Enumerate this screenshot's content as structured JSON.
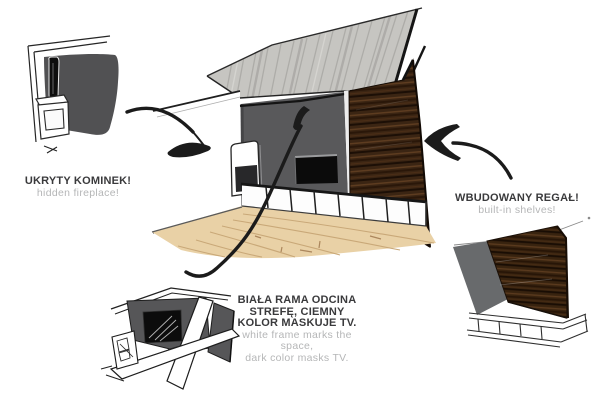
{
  "board": {
    "background": "#ffffff"
  },
  "labels": {
    "fireplace": {
      "title": "UKRYTY KOMINEK!",
      "subtitle": "hidden fireplace!"
    },
    "shelves": {
      "title": "WBUDOWANY REGAŁ!",
      "subtitle": "built-in shelves!"
    },
    "tv": {
      "title_lines": [
        "BIAŁA RAMA ODCINA",
        "STREFĘ, CIEMNY",
        "KOLOR MASKUJE TV."
      ],
      "subtitle_lines": [
        "white frame marks the",
        "space,",
        "dark color masks TV."
      ]
    }
  },
  "colors": {
    "title_text": "#3a3a3c",
    "subtitle_text": "#b5b6b7",
    "ink": "#1b1b1b",
    "wall_gray": "#59595b",
    "panel_gray": "#515153",
    "wood_brown": "#3b2513",
    "floor_tan": "#e9d1a6",
    "ceiling_gray": "#c6c5c1",
    "tv_black": "#0b0b0b"
  },
  "annotations": {
    "arrows": [
      {
        "name": "arrow-to-hidden-fireplace",
        "from": "fireplace detail sketch",
        "to": "main room left wall"
      },
      {
        "name": "arrow-to-tv-wall",
        "from": "tv frame detail sketch",
        "to": "main room dark tv wall"
      },
      {
        "name": "arrow-to-built-in-shelves",
        "from": "shelves label",
        "to": "main room wood wall"
      }
    ]
  }
}
